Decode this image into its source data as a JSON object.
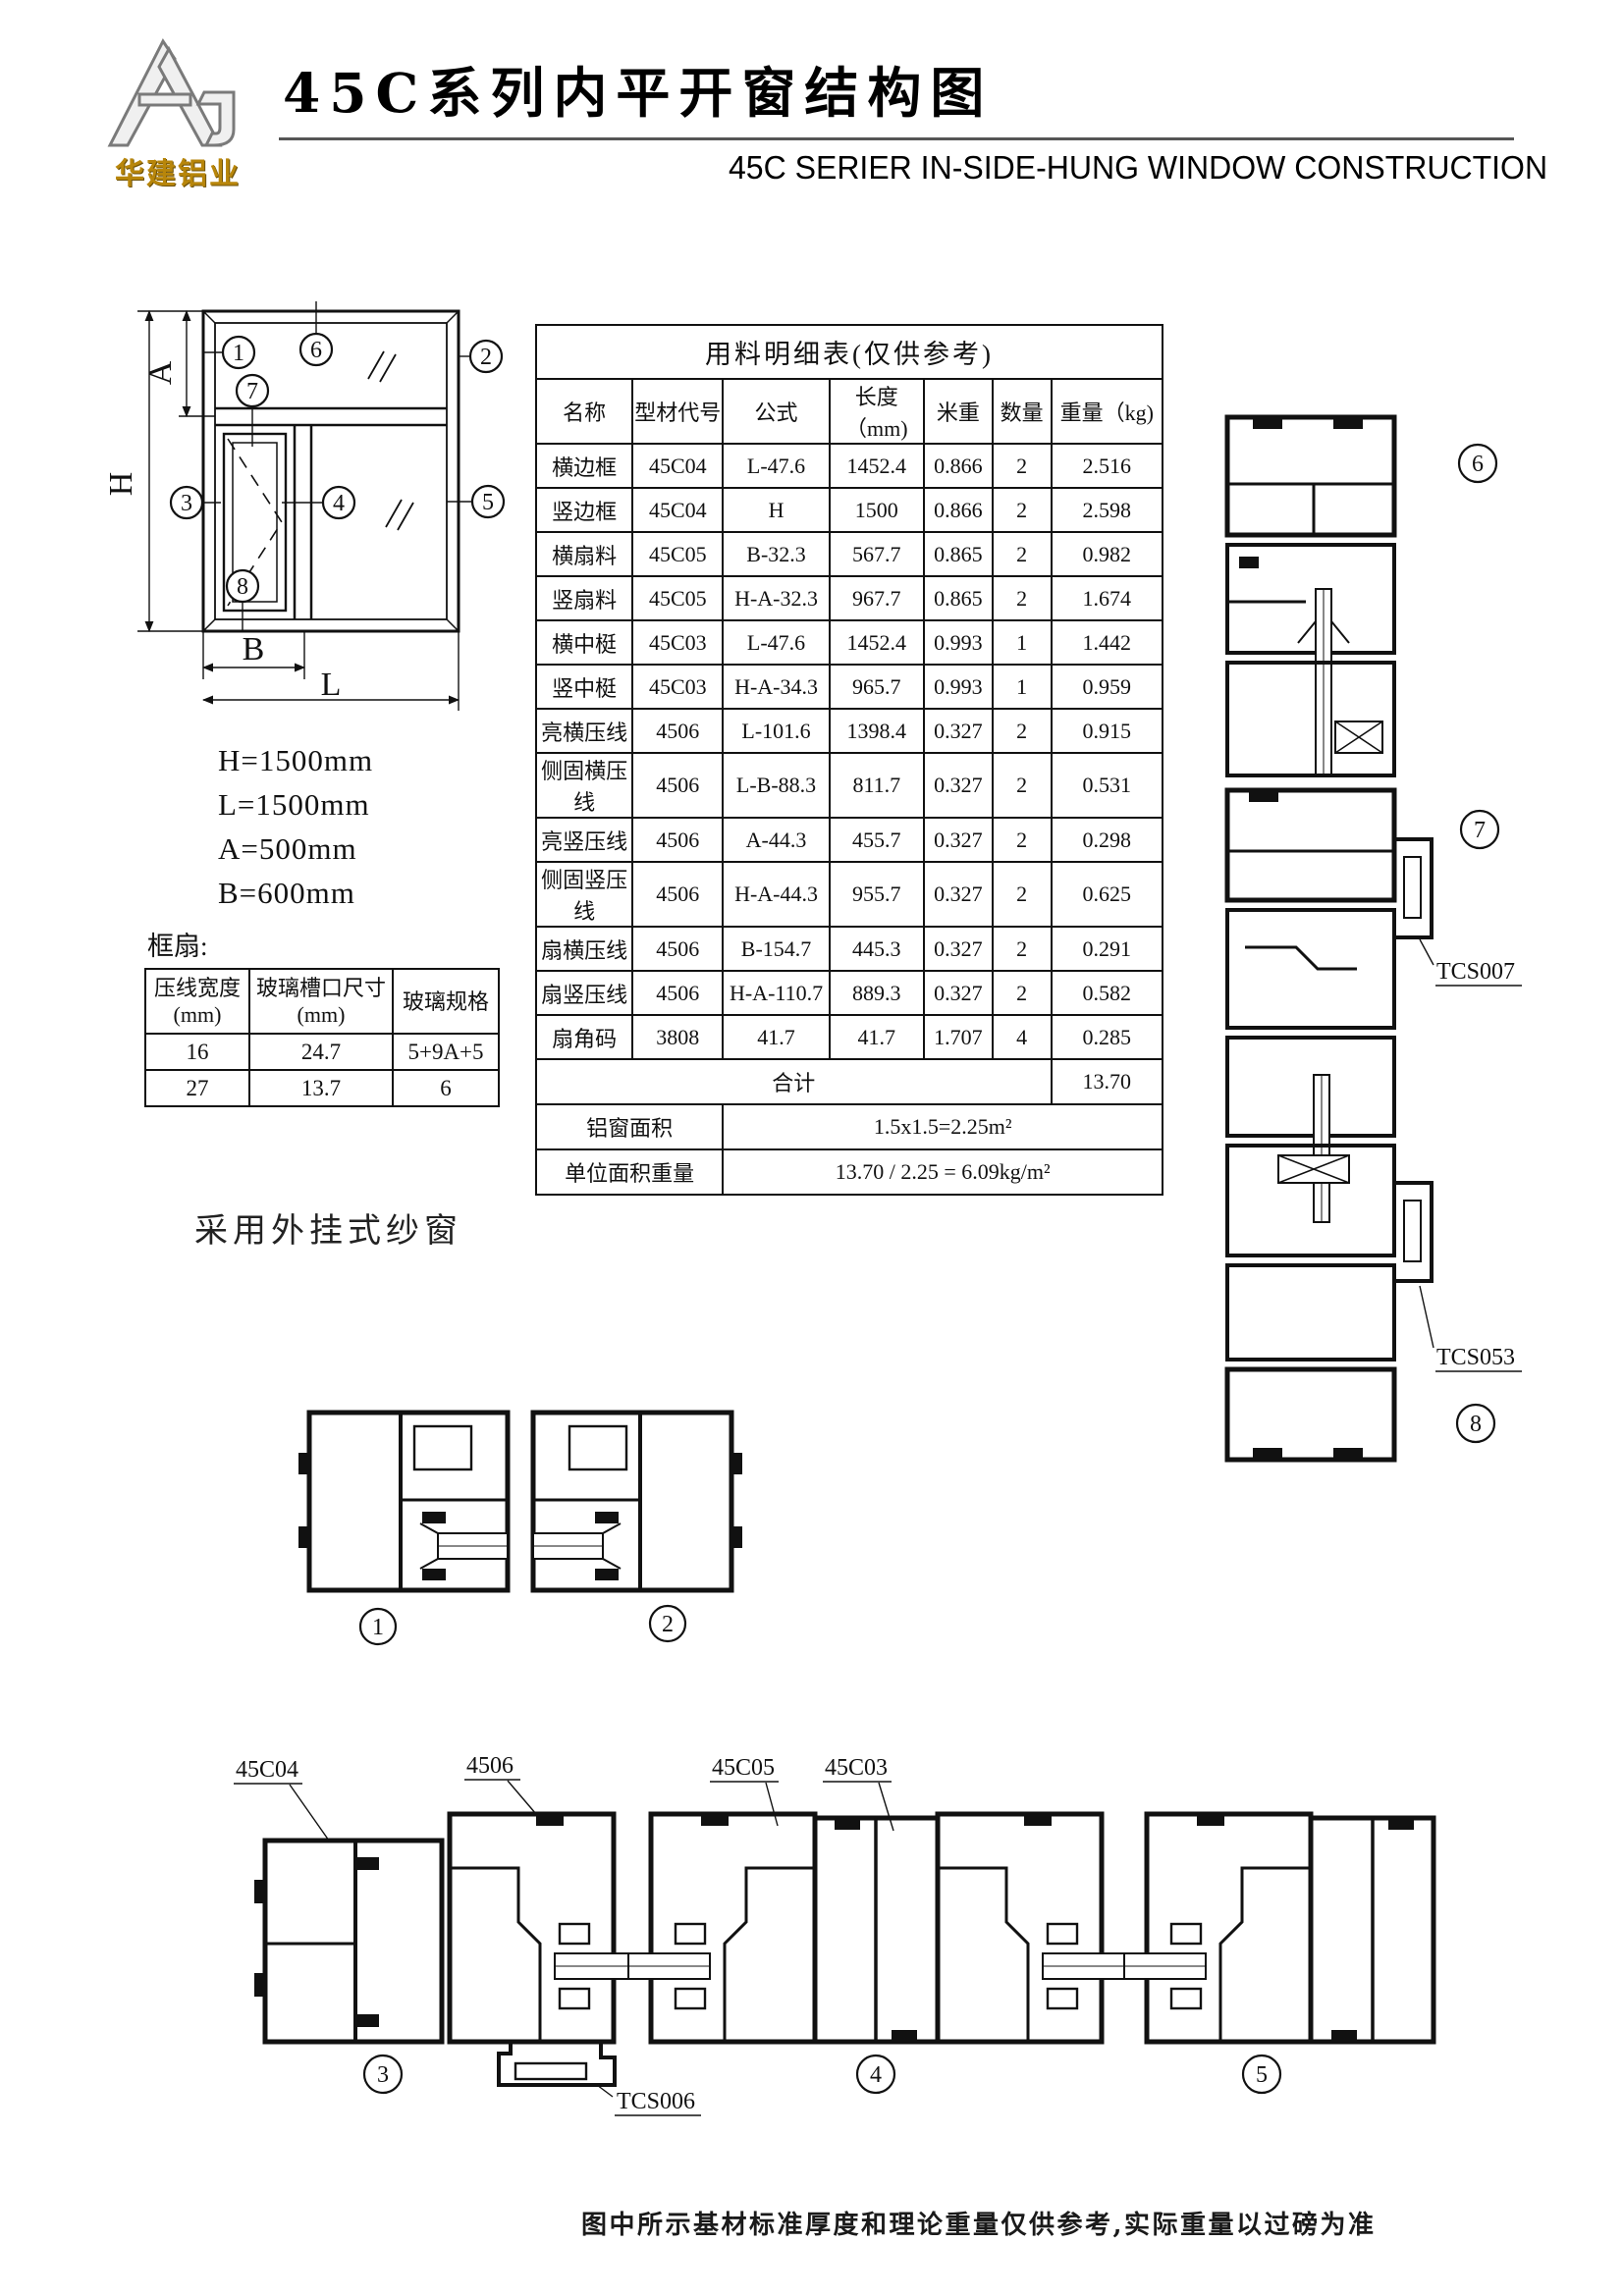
{
  "header": {
    "logo_text": "华建铝业",
    "title": "45C系列内平开窗结构图",
    "subtitle": "45C SERIER IN-SIDE-HUNG WINDOW CONSTRUCTION"
  },
  "elevation": {
    "callouts": {
      "c1": "1",
      "c2": "2",
      "c3": "3",
      "c4": "4",
      "c5": "5",
      "c6": "6",
      "c7": "7",
      "c8": "8"
    },
    "dim_labels": {
      "h": "H",
      "a": "A",
      "b": "B",
      "l": "L"
    },
    "dims": [
      "H=1500mm",
      "L=1500mm",
      "A=500mm",
      "B=600mm"
    ]
  },
  "frame_sash": {
    "label": "框扇:",
    "headers": [
      "压线宽度\n(mm)",
      "玻璃槽口尺寸\n(mm)",
      "玻璃规格"
    ],
    "rows": [
      [
        "16",
        "24.7",
        "5+9A+5"
      ],
      [
        "27",
        "13.7",
        "6"
      ]
    ]
  },
  "screen_note": "采用外挂式纱窗",
  "materials_table": {
    "title": "用料明细表(仅供参考)",
    "headers": [
      "名称",
      "型材代号",
      "公式",
      "长度（mm)",
      "米重",
      "数量",
      "重量（kg)"
    ],
    "rows": [
      [
        "横边框",
        "45C04",
        "L-47.6",
        "1452.4",
        "0.866",
        "2",
        "2.516"
      ],
      [
        "竖边框",
        "45C04",
        "H",
        "1500",
        "0.866",
        "2",
        "2.598"
      ],
      [
        "横扇料",
        "45C05",
        "B-32.3",
        "567.7",
        "0.865",
        "2",
        "0.982"
      ],
      [
        "竖扇料",
        "45C05",
        "H-A-32.3",
        "967.7",
        "0.865",
        "2",
        "1.674"
      ],
      [
        "横中梃",
        "45C03",
        "L-47.6",
        "1452.4",
        "0.993",
        "1",
        "1.442"
      ],
      [
        "竖中梃",
        "45C03",
        "H-A-34.3",
        "965.7",
        "0.993",
        "1",
        "0.959"
      ],
      [
        "亮横压线",
        "4506",
        "L-101.6",
        "1398.4",
        "0.327",
        "2",
        "0.915"
      ],
      [
        "侧固横压线",
        "4506",
        "L-B-88.3",
        "811.7",
        "0.327",
        "2",
        "0.531"
      ],
      [
        "亮竖压线",
        "4506",
        "A-44.3",
        "455.7",
        "0.327",
        "2",
        "0.298"
      ],
      [
        "侧固竖压线",
        "4506",
        "H-A-44.3",
        "955.7",
        "0.327",
        "2",
        "0.625"
      ],
      [
        "扇横压线",
        "4506",
        "B-154.7",
        "445.3",
        "0.327",
        "2",
        "0.291"
      ],
      [
        "扇竖压线",
        "4506",
        "H-A-110.7",
        "889.3",
        "0.327",
        "2",
        "0.582"
      ],
      [
        "扇角码",
        "3808",
        "41.7",
        "41.7",
        "1.707",
        "4",
        "0.285"
      ]
    ],
    "total_label": "合计",
    "total_value": "13.70",
    "area_label": "铝窗面积",
    "area_value": "1.5x1.5=2.25m²",
    "unit_label": "单位面积重量",
    "unit_value": "13.70 / 2.25 = 6.09kg/m²"
  },
  "sections": {
    "c1": "1",
    "c2": "2",
    "c3": "3",
    "c4": "4",
    "c5": "5",
    "c6": "6",
    "c7": "7",
    "c8": "8",
    "labels": [
      "45C04",
      "4506",
      "45C05",
      "45C03"
    ],
    "tcs006": "TCS006",
    "tcs007": "TCS007",
    "tcs053": "TCS053"
  },
  "footer": "图中所示基材标准厚度和理论重量仅供参考,实际重量以过磅为准"
}
